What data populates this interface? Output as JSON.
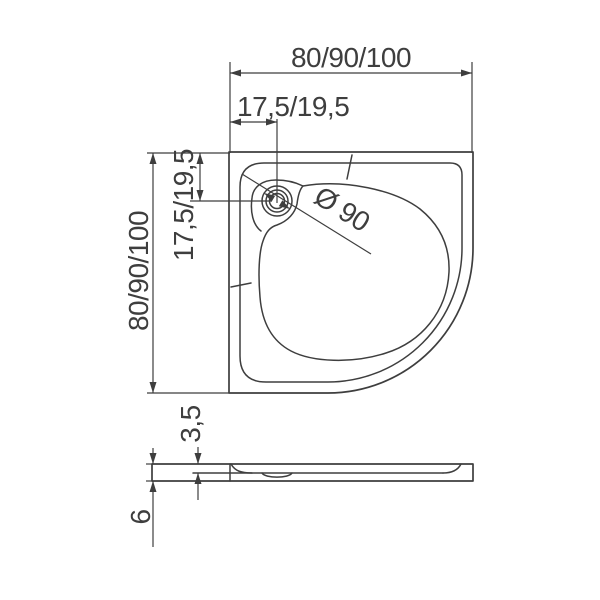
{
  "drawing": {
    "type": "technical-dimension-drawing",
    "subject": "quarter-circle corner shower tray, plan view and side section",
    "background_color": "#ffffff",
    "line_color": "#3e3e3e",
    "plan": {
      "width_label": "80/90/100",
      "height_label": "80/90/100",
      "drain_offset_horizontal_label": "17,5/19,5",
      "drain_offset_vertical_label": "17,5/19,5",
      "drain_diameter_label": "Ø 90"
    },
    "section": {
      "rim_height_label": "3,5",
      "total_height_label": "6"
    }
  }
}
